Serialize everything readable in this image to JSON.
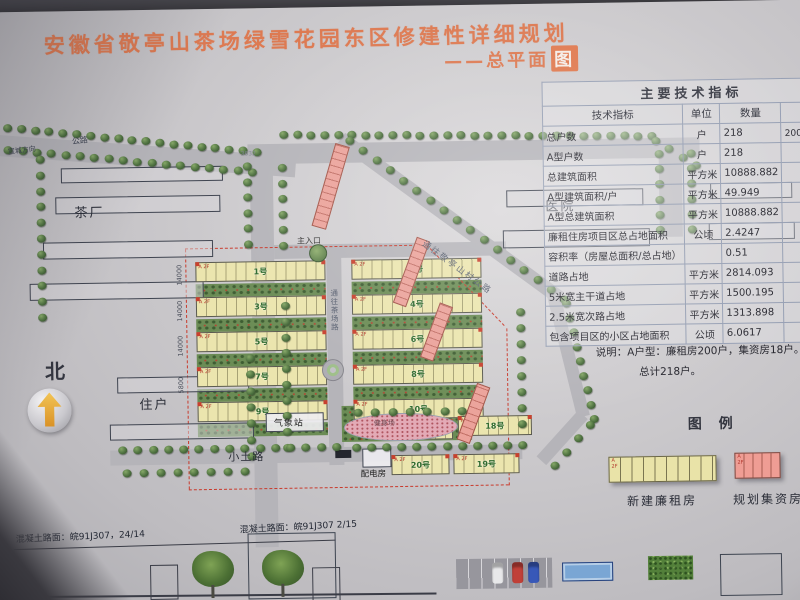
{
  "title": {
    "main": "安徽省敬亭山茶场绿雪花园东区修建性详细规划",
    "subtitle_prefix": "——总平面",
    "subtitle_boxed": "图"
  },
  "table": {
    "title": "主要技术指标",
    "headers": [
      "技术指标",
      "单位",
      "数量",
      "备注"
    ],
    "rows": [
      [
        "总户数",
        "户",
        "218",
        "200户廉租房"
      ],
      [
        "A型户数",
        "户",
        "218",
        ""
      ],
      [
        "总建筑面积",
        "平方米",
        "10888.882",
        ""
      ],
      [
        "A型建筑面积/户",
        "平方米",
        "49.949",
        ""
      ],
      [
        "A型总建筑面积",
        "平方米",
        "10888.882",
        ""
      ],
      [
        "廉租住房项目区总占地面积",
        "公顷",
        "2.4247",
        ""
      ],
      [
        "容积率（房屋总面积/总占地）",
        "",
        "0.51",
        ""
      ],
      [
        "道路占地",
        "平方米",
        "2814.093",
        ""
      ],
      [
        "5米宽主干道占地",
        "平方米",
        "1500.195",
        ""
      ],
      [
        "2.5米宽次路占地",
        "平方米",
        "1313.898",
        ""
      ],
      [
        "包含项目区的小区占地面积",
        "公顷",
        "6.0617",
        ""
      ]
    ],
    "note_line1": "说明：A户型：廉租房200户，集资房18户。",
    "note_line2": "总计218户。"
  },
  "legend": {
    "title": "图  例",
    "items": [
      {
        "label": "新建廉租房",
        "color": "#e9e3a8"
      },
      {
        "label": "规划集资房",
        "color": "#ef9d94"
      }
    ]
  },
  "north_label": "北",
  "plan": {
    "labels": [
      {
        "id": "tea-factory",
        "text": "茶厂"
      },
      {
        "id": "hospital",
        "text": "医院"
      },
      {
        "id": "residents",
        "text": "住户"
      },
      {
        "id": "main-entrance",
        "text": "主入口"
      },
      {
        "id": "weather-station",
        "text": "气象站"
      },
      {
        "id": "dirt-road",
        "text": "小土路"
      },
      {
        "id": "power-room",
        "text": "配电房"
      },
      {
        "id": "fitness-ground",
        "text": "健身场"
      },
      {
        "id": "highway-name",
        "text": "公路"
      },
      {
        "id": "highway-direction",
        "text": "宣城方向"
      },
      {
        "id": "ne-road",
        "text": "通往敬亭山村公路"
      },
      {
        "id": "center-road",
        "text": "通往茶场路"
      },
      {
        "id": "dim-note",
        "text": "3632"
      }
    ],
    "buildings": {
      "grid_left": [
        "1号",
        "3号",
        "5号",
        "7号",
        "9号"
      ],
      "grid_right": [
        "2号",
        "4号",
        "6号",
        "8号",
        "10号"
      ],
      "extra": [
        {
          "id": "b21",
          "label": "21号"
        },
        {
          "id": "b18",
          "label": "18号"
        },
        {
          "id": "b20",
          "label": "20号"
        },
        {
          "id": "b19",
          "label": "19号"
        }
      ],
      "unit_marks": [
        "A",
        "2F"
      ]
    },
    "dimensions": [
      "14000",
      "14000",
      "14000",
      "5800"
    ]
  },
  "bottom_notes": [
    {
      "id": "pavement-note-1",
      "text": "混凝土路面：皖91J307，24/14"
    },
    {
      "id": "pavement-note-2",
      "text": "混凝土路面：皖91J307 2/15"
    }
  ],
  "colors": {
    "title_orange": "#dd7a52",
    "rent_housing_yellow": "#ebe5ae",
    "funded_housing_pink": "#eba29a",
    "boundary_red": "#c93a2c",
    "tree_green": "#4e7140",
    "road_gray": "#b5b4b9"
  }
}
